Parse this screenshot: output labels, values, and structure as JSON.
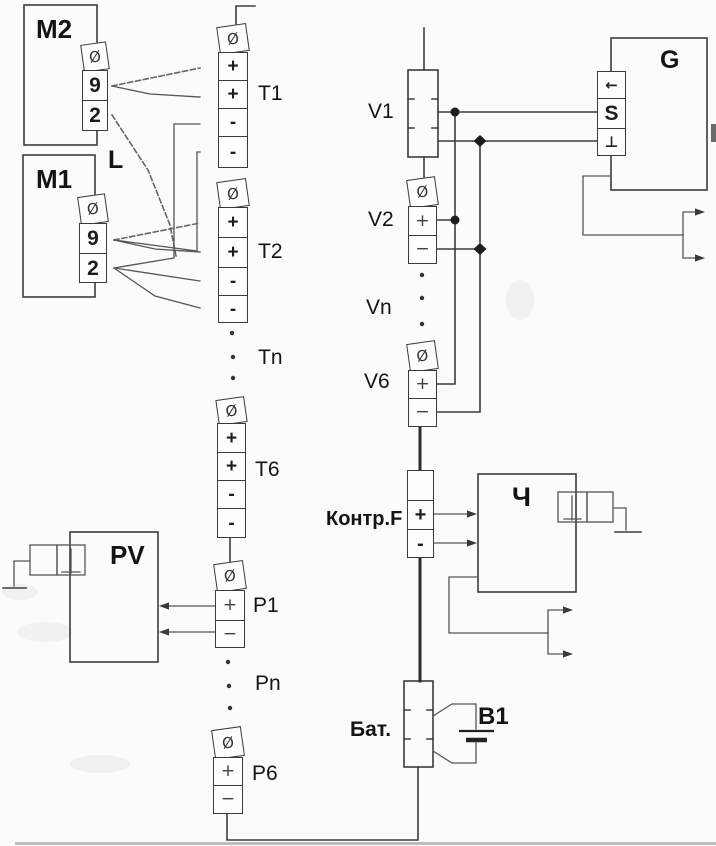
{
  "colors": {
    "line": "#3d3d3d",
    "text": "#141414",
    "background": "#fbfbf9"
  },
  "blocks": {
    "m2": "M2",
    "m1": "M1",
    "l": "L",
    "pv": "PV",
    "g": "G",
    "ch": "Ч",
    "battery": "Бат.",
    "b1": "В1",
    "kontrf": "Контр.F"
  },
  "strips": {
    "m2_strip": {
      "cells": [
        "Ø",
        "9",
        "2"
      ]
    },
    "m1_strip": {
      "cells": [
        "Ø",
        "9",
        "2"
      ]
    },
    "t1": {
      "label": "T1",
      "cells": [
        "Ø",
        "+",
        "+",
        "-",
        "-"
      ]
    },
    "t2": {
      "label": "T2",
      "cells": [
        "Ø",
        "+",
        "+",
        "-",
        "-"
      ]
    },
    "tn": {
      "label": "Tn"
    },
    "t6": {
      "label": "T6",
      "cells": [
        "Ø",
        "+",
        "+",
        "-",
        "-"
      ]
    },
    "p1": {
      "label": "P1",
      "cells": [
        "Ø",
        "+",
        "−"
      ]
    },
    "pn": {
      "label": "Pn"
    },
    "p6": {
      "label": "P6",
      "cells": [
        "Ø",
        "+",
        "−"
      ]
    },
    "v1": {
      "label": "V1"
    },
    "v2": {
      "label": "V2",
      "cells": [
        "Ø",
        "+",
        "−"
      ]
    },
    "vn": {
      "label": "Vn"
    },
    "v6": {
      "label": "V6",
      "cells": [
        "Ø",
        "+",
        "−"
      ]
    },
    "kontrf_strip": {
      "cells": [
        "",
        "+",
        "-"
      ]
    },
    "g_strip": {
      "cells": [
        "←",
        "S",
        "⊥"
      ]
    }
  }
}
